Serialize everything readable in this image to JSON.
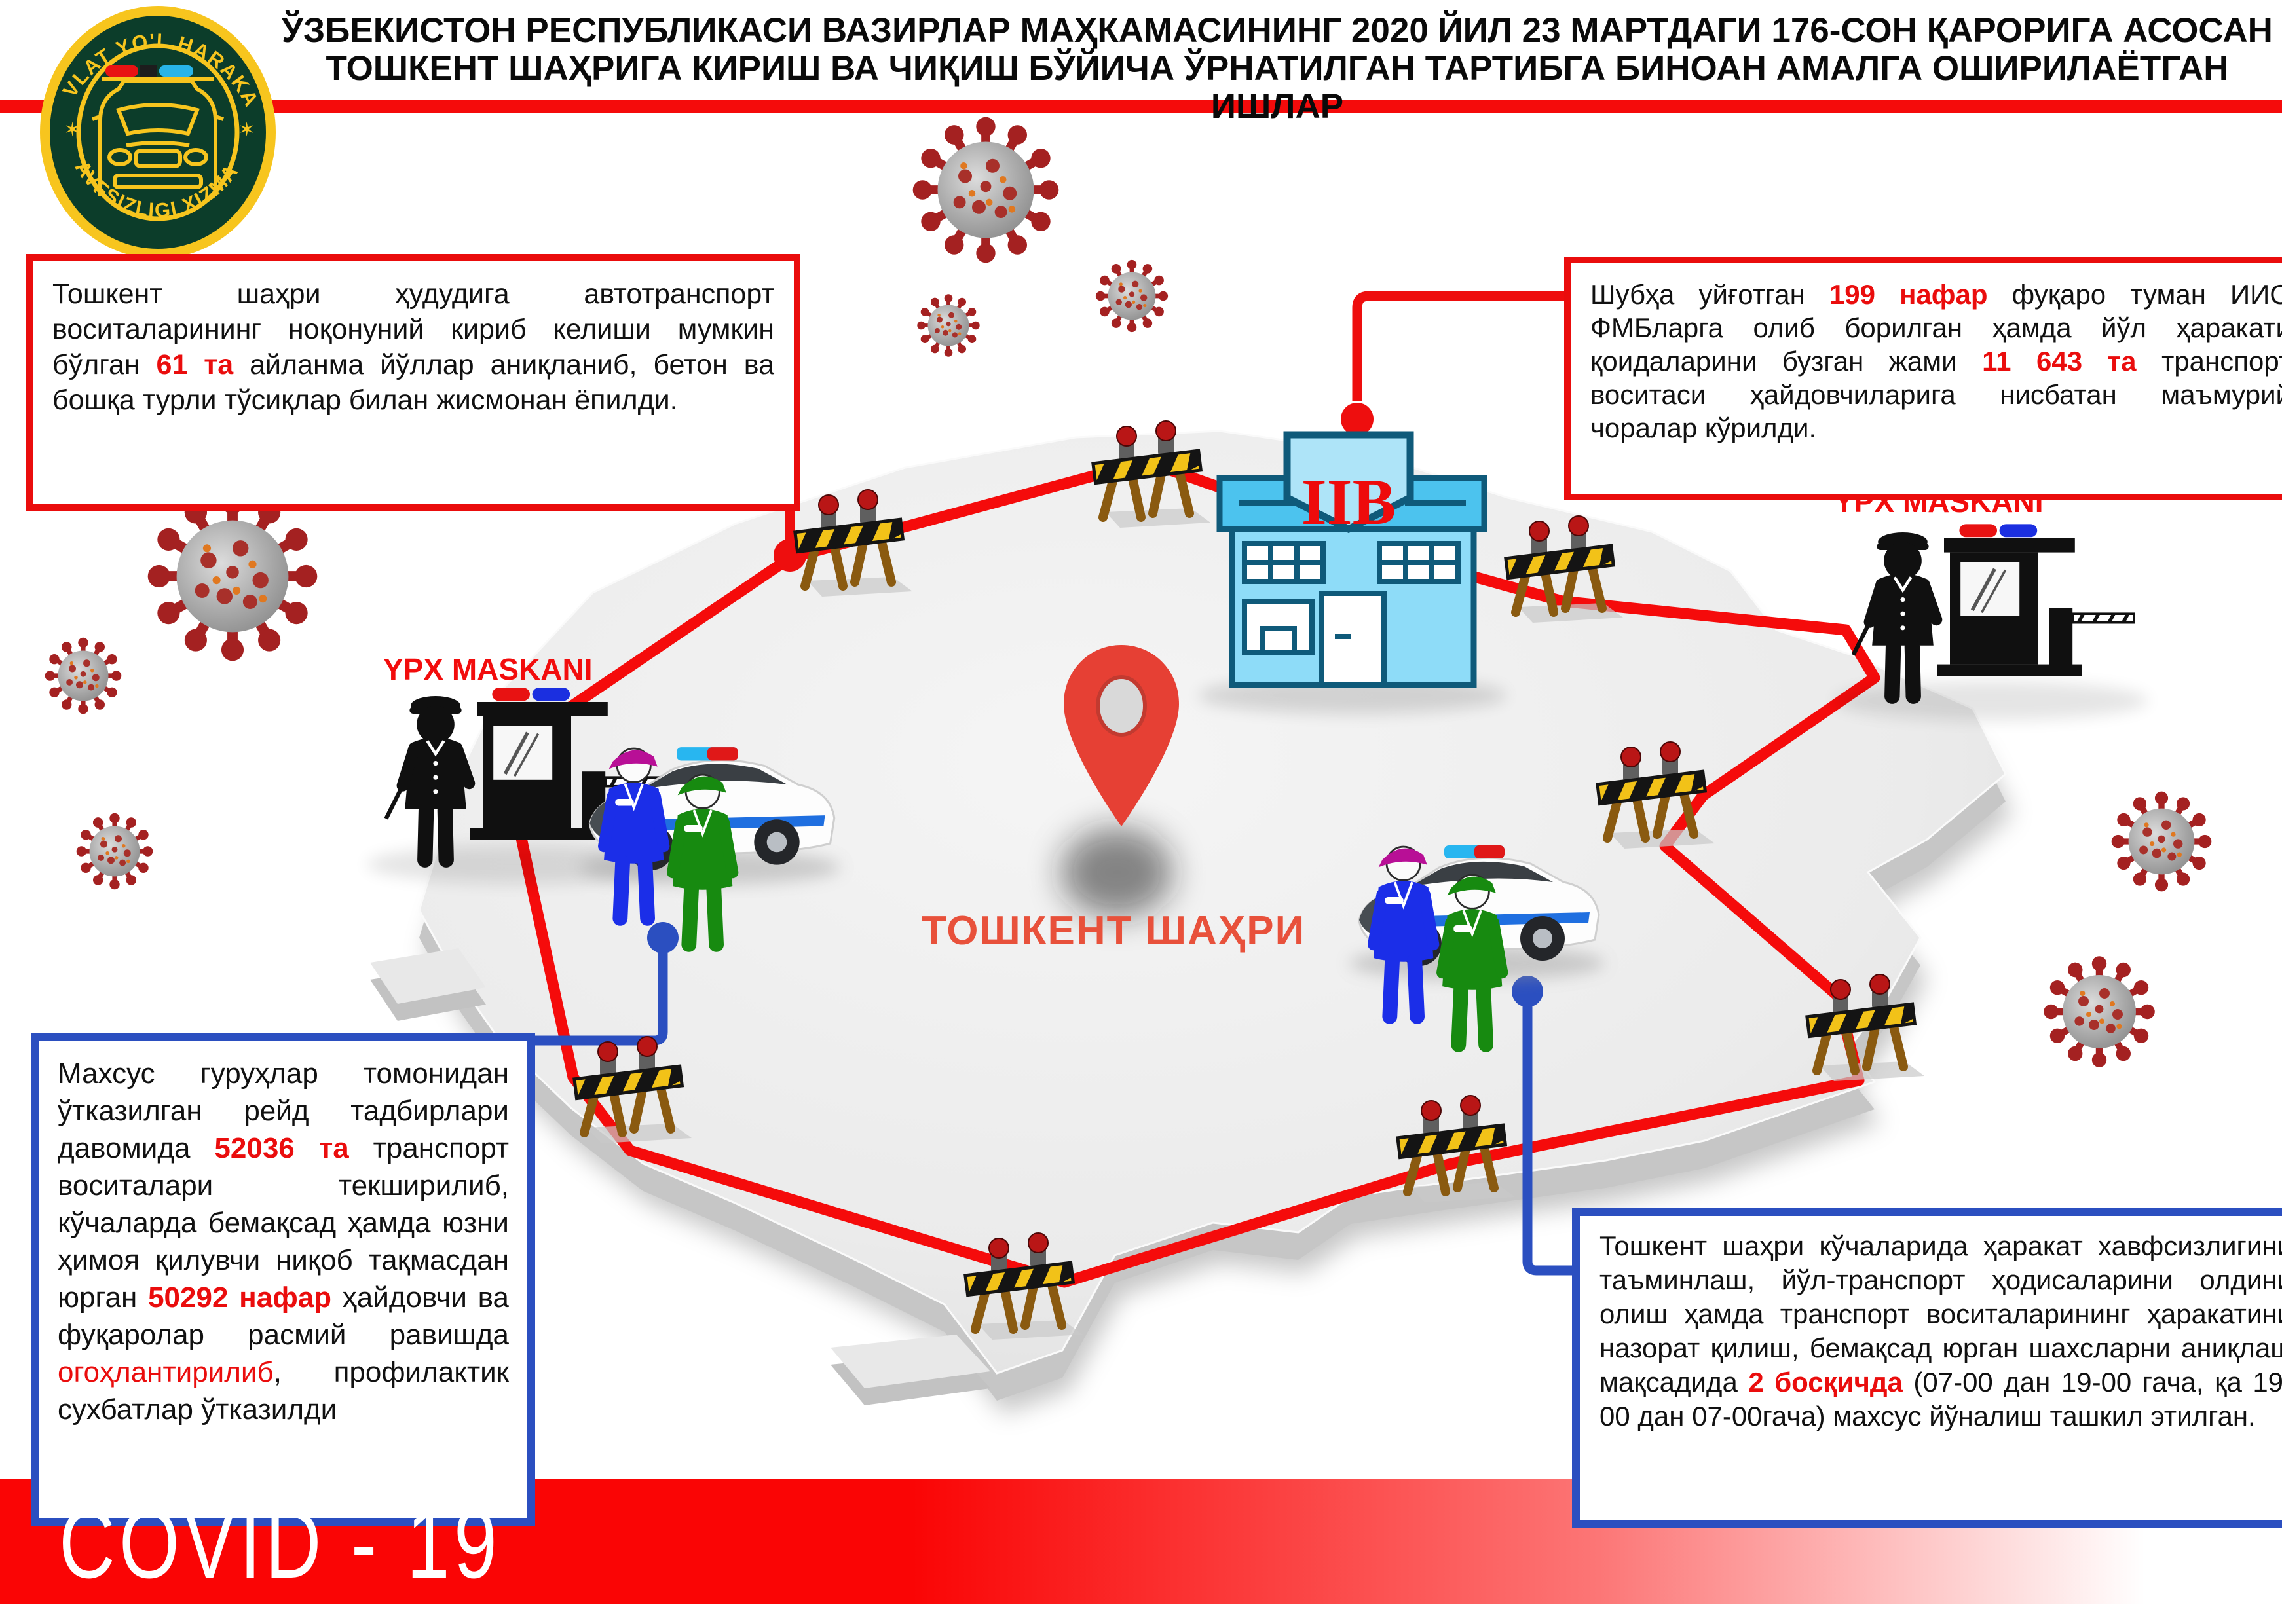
{
  "header": {
    "title_line1": "ЎЗБЕКИСТОН РЕСПУБЛИКАСИ ВАЗИРЛАР МАҲКАМАСИНИНГ 2020 ЙИЛ 23 МАРТДАГИ 176-СОН ҚАРОРИГА АСОСАН",
    "title_line2": "ТОШКЕНТ ШАҲРИГА КИРИШ ВА ЧИҚИШ БЎЙИЧА ЎРНАТИЛГАН ТАРТИБГА БИНОАН АМАЛГА ОШИРИЛАЁТГАН ИШЛАР"
  },
  "logo": {
    "top_text": "DAVLAT YO'L HARAKATI",
    "bottom_text": "XAVFSIZLIGI XIZMATI",
    "star_left": "✶",
    "star_right": "✶"
  },
  "map": {
    "city_label": "ТОШКЕНТ ШАҲРИ",
    "iib_label": "IIB",
    "checkpoint_left_label": "YPX MASKANI",
    "checkpoint_right_label": "YPX MASKANI"
  },
  "boxes": {
    "left_red": {
      "a": "Тошкент шаҳри ҳудудига автотранспорт воситаларининг ноқонуний кириб келиши мумкин бўлган ",
      "b": "61 та",
      "c": " айланма йўллар аниқланиб, бетон ва бошқа турли тўсиқлар билан жисмонан ёпилди."
    },
    "right_red": {
      "a": "Шубҳа уйғотган ",
      "b": "199 нафар",
      "c": " фуқаро туман ИИО ФМБларга олиб борилган ҳамда йўл ҳаракати қоидаларини бузган жами ",
      "d": "11 643 та",
      "e": " транспорт воситаси ҳайдовчиларига нисбатан маъмурий чоралар кўрилди."
    },
    "left_blue": {
      "a": "Махсус гуруҳлар томонидан ўтказилган рейд тадбирлари давомида ",
      "b": "52036 та",
      "c": " транспорт воситалари текширилиб, кўчаларда бемақсад ҳамда юзни ҳимоя қилувчи ниқоб тақмасдан юрган ",
      "d": "50292 нафар",
      "e": " ҳайдовчи ва фуқаролар расмий равишда ",
      "f": "огоҳлантирилиб",
      "g": ", профилактик сухбатлар ўтказилди"
    },
    "right_blue": {
      "a": "Тошкент шаҳри кўчаларида ҳаракат хавфсизлигини таъминлаш, йўл-транспорт ҳодисаларини олдини олиш ҳамда транспорт воситаларининг ҳаракатини назорат қилиш, бемақсад юрган шахсларни аниқлаш мақсадида ",
      "b": "2 босқичда",
      "c": " (07-00 дан 19-00 гача, қа 19-00 дан 07-00гача) махсус йўналиш ташкил этилган."
    }
  },
  "footer": {
    "covid_label": "COVID - 19"
  },
  "colors": {
    "accent_red": "#ea0d0d",
    "accent_blue": "#2b4fc0",
    "route_red": "#f50b0b",
    "map_gray": "#ededed",
    "building_blue": "#8edcf8",
    "badge_green": "#0c3d2a",
    "badge_yellow": "#f7c51e"
  }
}
